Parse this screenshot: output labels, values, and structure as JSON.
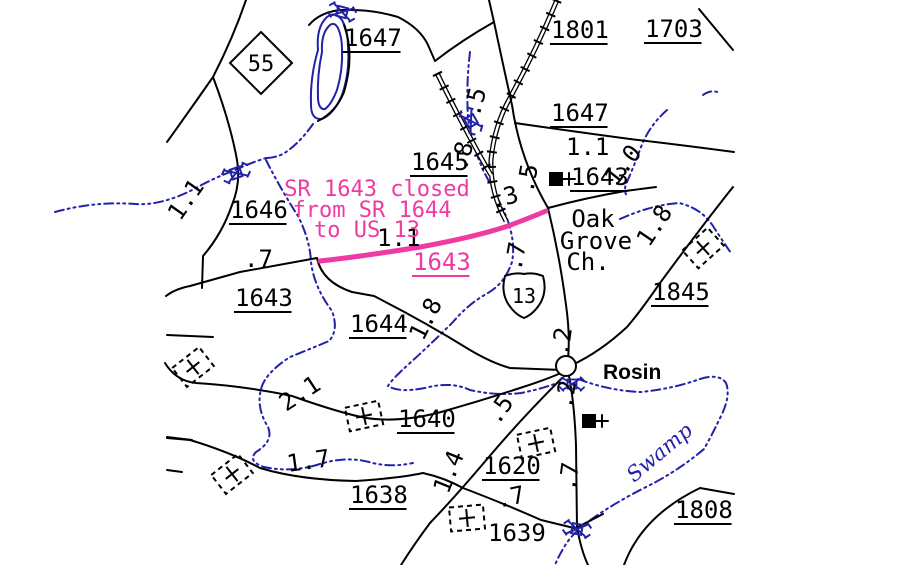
{
  "colors": {
    "road": "#000000",
    "water": "#2222A8",
    "closure": "#EE3AA2",
    "background": "#FFFFFF"
  },
  "route_markers": {
    "nc_route": "55",
    "us_route": "13"
  },
  "map": {
    "route_labels": [
      {
        "t": "1647",
        "x": 344,
        "y": 46,
        "u": 1
      },
      {
        "t": "1801",
        "x": 551,
        "y": 38,
        "u": 1
      },
      {
        "t": "1703",
        "x": 645,
        "y": 37,
        "u": 1
      },
      {
        "t": "1647",
        "x": 551,
        "y": 121,
        "u": 1
      },
      {
        "t": "1645",
        "x": 411,
        "y": 170,
        "u": 1
      },
      {
        "t": "1643",
        "x": 571,
        "y": 185,
        "u": 1
      },
      {
        "t": "1646",
        "x": 230,
        "y": 218,
        "u": 1
      },
      {
        "t": "1643",
        "x": 235,
        "y": 306,
        "u": 1
      },
      {
        "t": "1644",
        "x": 350,
        "y": 332,
        "u": 1
      },
      {
        "t": "1845",
        "x": 652,
        "y": 300,
        "u": 1
      },
      {
        "t": "1640",
        "x": 398,
        "y": 427,
        "u": 1
      },
      {
        "t": "1620",
        "x": 483,
        "y": 474,
        "u": 1
      },
      {
        "t": "1638",
        "x": 350,
        "y": 503,
        "u": 1
      },
      {
        "t": "1639",
        "x": 488,
        "y": 541
      },
      {
        "t": "1808",
        "x": 675,
        "y": 518,
        "u": 1
      },
      {
        "t": "1643",
        "x": 413,
        "y": 270,
        "u": 1,
        "c": "p"
      }
    ],
    "mileage_labels": [
      {
        "t": ".5",
        "x": 479,
        "y": 118,
        "r": -75
      },
      {
        "t": ".8",
        "x": 466,
        "y": 172,
        "r": -75
      },
      {
        "t": ".5",
        "x": 533,
        "y": 194,
        "r": -80
      },
      {
        "t": ".3",
        "x": 492,
        "y": 209,
        "r": -15
      },
      {
        "t": "1.1",
        "x": 566,
        "y": 155
      },
      {
        "t": "1.0",
        "x": 616,
        "y": 187,
        "r": -52
      },
      {
        "t": "1.8",
        "x": 649,
        "y": 248,
        "r": -56
      },
      {
        "t": "1.1",
        "x": 377,
        "y": 246
      },
      {
        "t": "1.1",
        "x": 180,
        "y": 222,
        "r": -55
      },
      {
        "t": ".7",
        "x": 244,
        "y": 267
      },
      {
        "t": ".7",
        "x": 521,
        "y": 272,
        "r": -80
      },
      {
        "t": "1.8",
        "x": 423,
        "y": 342,
        "r": -63
      },
      {
        "t": "2.1",
        "x": 286,
        "y": 412,
        "r": -33
      },
      {
        "t": ".2",
        "x": 568,
        "y": 357,
        "r": -82
      },
      {
        "t": ".2",
        "x": 572,
        "y": 410,
        "r": -82
      },
      {
        "t": ".5",
        "x": 498,
        "y": 426,
        "r": -55
      },
      {
        "t": "1.4",
        "x": 448,
        "y": 495,
        "r": -68
      },
      {
        "t": "1.7",
        "x": 288,
        "y": 472,
        "r": -8
      },
      {
        "t": ".7",
        "x": 498,
        "y": 508,
        "r": -12
      },
      {
        "t": ".7",
        "x": 575,
        "y": 492,
        "r": -82
      }
    ],
    "place_labels": [
      {
        "t": "Oak",
        "x": 593,
        "y": 227,
        "a": "m"
      },
      {
        "t": "Grove",
        "x": 596,
        "y": 249,
        "a": "m"
      },
      {
        "t": "Ch.",
        "x": 588,
        "y": 270,
        "a": "m"
      },
      {
        "t": "Rosin",
        "x": 603,
        "y": 379,
        "c": "town",
        "fs": 21
      },
      {
        "t": "Swamp",
        "x": 634,
        "y": 483,
        "r": -40,
        "c": "sw",
        "fs": 21
      }
    ],
    "closure_labels": [
      {
        "t": "SR 1643 closed",
        "x": 377,
        "y": 196,
        "a": "m",
        "c": "p",
        "fs": 22
      },
      {
        "t": "from SR 1644",
        "x": 372,
        "y": 217,
        "a": "m",
        "c": "p",
        "fs": 22
      },
      {
        "t": "to US 13",
        "x": 367,
        "y": 237,
        "a": "m",
        "c": "p",
        "fs": 22
      }
    ],
    "symbols": {
      "church": "filled-square-with-cross",
      "cemetery": "dashed-square-with-cross",
      "bridge": "blue-x-crossing",
      "town": "open-circle",
      "nc_route_marker": "diamond",
      "us_route_marker": "us-shield",
      "stream": "blue-dash-dot-line",
      "railroad": "double-line-with-ties"
    }
  }
}
